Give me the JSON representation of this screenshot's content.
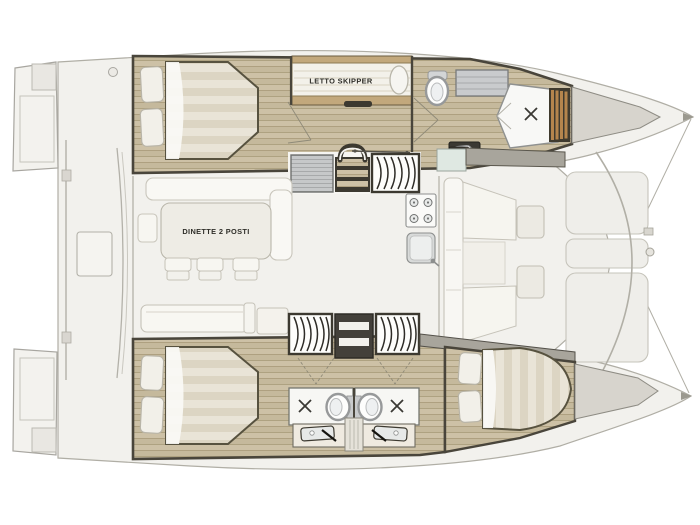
{
  "page": {
    "type": "catamaran-floor-plan",
    "background": "#ffffff"
  },
  "labels": {
    "skipper_bed": "LETTO SKIPPER",
    "dinette": "DINETTE 2 POSTI"
  },
  "colors": {
    "deck": "#f2f1ed",
    "deck_outline": "#b0aea5",
    "hull_wall": "#49453b",
    "wood_floor": "#cdc1a6",
    "wood_plank_seam": "#ab9e7d",
    "bed_trim_wood": "#c2a87c",
    "duvet_light": "#e9e4d7",
    "duvet_stripe": "#dcd5c3",
    "pillow": "#f2f0e9",
    "fixture_white": "#fbfbf9",
    "fixture_gray": "#c8cacb",
    "counter_dark": "#3b3933",
    "teak_slats": "#b5854d",
    "bow_wedge": "#d7d4cd",
    "gray_band": "#a8a59c",
    "glass_tint": "#dfe8e2",
    "trampoline": "#efeeea",
    "label_text": "#2f2e29"
  },
  "icons": [
    {
      "name": "toilet-icon",
      "count": 3
    },
    {
      "name": "shower-drain-icon",
      "count": 3
    },
    {
      "name": "sink-icon",
      "count": 3
    },
    {
      "name": "stove-icon",
      "count": 1
    },
    {
      "name": "galley-sink-icon",
      "count": 1
    },
    {
      "name": "staircase-icon",
      "count": 3
    },
    {
      "name": "companionway-steps-icon",
      "count": 1
    },
    {
      "name": "double-bed",
      "count": 4
    },
    {
      "name": "pillow",
      "count": 7
    },
    {
      "name": "trampoline-panel",
      "count": 3
    }
  ]
}
